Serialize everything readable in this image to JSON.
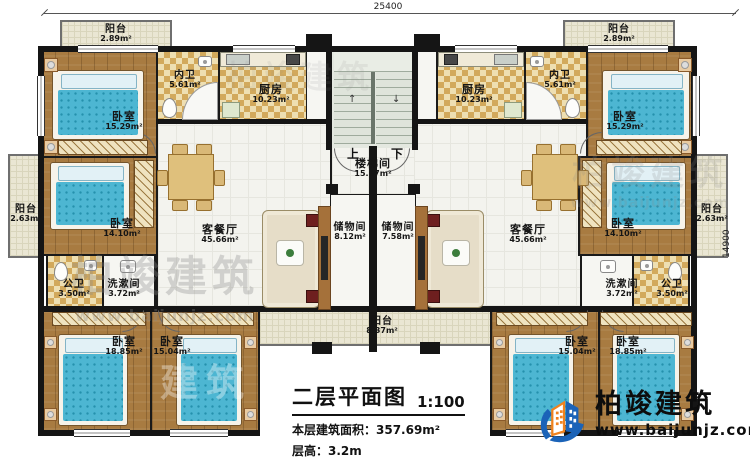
{
  "dimensions": {
    "top": "25400",
    "right": "14900"
  },
  "stair": {
    "up": "上",
    "down": "下"
  },
  "rooms": {
    "balcony_tl": {
      "name": "阳台",
      "area": "2.89m²"
    },
    "balcony_tr": {
      "name": "阳台",
      "area": "2.89m²"
    },
    "bedroom_tl": {
      "name": "卧室",
      "area": "15.29m²"
    },
    "bedroom_tr": {
      "name": "卧室",
      "area": "15.29m²"
    },
    "innerbath_l": {
      "name": "内卫",
      "area": "5.61m²"
    },
    "innerbath_r": {
      "name": "内卫",
      "area": "5.61m²"
    },
    "kitchen_l": {
      "name": "厨房",
      "area": "10.23m²"
    },
    "kitchen_r": {
      "name": "厨房",
      "area": "10.23m²"
    },
    "stairwell": {
      "name": "楼梯间",
      "area": "15.67m²"
    },
    "living_l": {
      "name": "客餐厅",
      "area": "45.66m²"
    },
    "living_r": {
      "name": "客餐厅",
      "area": "45.66m²"
    },
    "storage_l": {
      "name": "储物间",
      "area": "8.12m²"
    },
    "storage_r": {
      "name": "储物间",
      "area": "7.58m²"
    },
    "balcony_ml": {
      "name": "阳台",
      "area": "2.63m²"
    },
    "balcony_mr": {
      "name": "阳台",
      "area": "2.63m²"
    },
    "bedroom_ml": {
      "name": "卧室",
      "area": "14.10m²"
    },
    "bedroom_mr": {
      "name": "卧室",
      "area": "14.10m²"
    },
    "pubbath_l": {
      "name": "公卫",
      "area": "3.50m²"
    },
    "pubbath_r": {
      "name": "公卫",
      "area": "3.50m²"
    },
    "wash_l": {
      "name": "洗漱间",
      "area": "3.72m²"
    },
    "wash_r": {
      "name": "洗漱间",
      "area": "3.72m²"
    },
    "bedroom_bl1": {
      "name": "卧室",
      "area": "18.85m²"
    },
    "bedroom_bl2": {
      "name": "卧室",
      "area": "15.04m²"
    },
    "bedroom_br1": {
      "name": "卧室",
      "area": "15.04m²"
    },
    "bedroom_br2": {
      "name": "卧室",
      "area": "18.85m²"
    },
    "balcony_b": {
      "name": "阳台",
      "area": "8.37m²"
    }
  },
  "title_block": {
    "title": "二层平面图",
    "scale": "1:100",
    "area_label": "本层建筑面积：357.69m²",
    "height_label": "层高：3.2m"
  },
  "brand": {
    "name": "柏竣建筑",
    "website": "www.baijunjz.com"
  },
  "watermark": {
    "name": "柏竣建筑",
    "url": "www.baijunjz.com",
    "ghost": "建筑"
  }
}
